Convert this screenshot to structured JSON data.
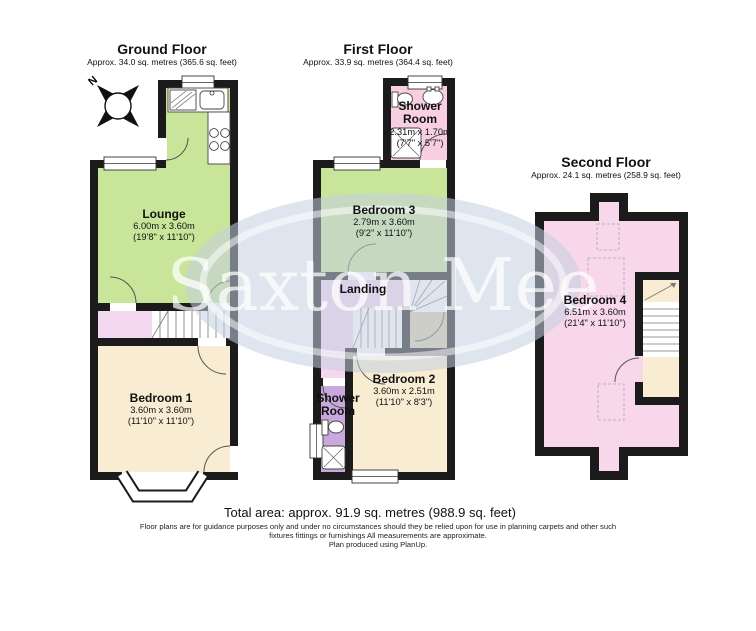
{
  "colors": {
    "wall": "#1b1b1b",
    "green": "#c8e59a",
    "cream": "#f8ecd2",
    "hallpink": "#f3d8ef",
    "showerpink": "#f7cfe1",
    "purple": "#c9a9dd",
    "tan": "#d8cdab",
    "bed4pink": "#f7d7e9",
    "watermark": "#c4d0e0"
  },
  "compass": {
    "label": "N"
  },
  "watermark": {
    "text": "Saxton Mee"
  },
  "floors": {
    "ground": {
      "title": "Ground Floor",
      "subtitle": "Approx. 34.0 sq. metres (365.6 sq. feet)"
    },
    "first": {
      "title": "First Floor",
      "subtitle": "Approx. 33.9 sq. metres (364.4 sq. feet)"
    },
    "second": {
      "title": "Second Floor",
      "subtitle": "Approx. 24.1 sq. metres (258.9 sq. feet)"
    }
  },
  "rooms": {
    "lounge": {
      "name": "Lounge",
      "metric": "6.00m x 3.60m",
      "imperial": "(19'8\" x 11'10\")"
    },
    "bedroom1": {
      "name": "Bedroom 1",
      "metric": "3.60m x 3.60m",
      "imperial": "(11'10\" x 11'10\")"
    },
    "shower1": {
      "name": "Shower Room",
      "metric": "2.31m x 1.70m",
      "imperial": "(7'7\" x 5'7\")"
    },
    "bedroom3": {
      "name": "Bedroom 3",
      "metric": "2.79m x 3.60m",
      "imperial": "(9'2\" x 11'10\")"
    },
    "landing": {
      "name": "Landing"
    },
    "bedroom2": {
      "name": "Bedroom 2",
      "metric": "3.60m x 2.51m",
      "imperial": "(11'10\" x 8'3\")"
    },
    "shower2": {
      "name": "Shower Room"
    },
    "bedroom4": {
      "name": "Bedroom 4",
      "metric": "6.51m x 3.60m",
      "imperial": "(21'4\" x 11'10\")"
    }
  },
  "footer": {
    "total_area": "Total area: approx. 91.9 sq. metres (988.9 sq. feet)",
    "disclaimer_line1": "Floor plans are for guidance purposes only and under no circumstances should they be relied upon for use in planning carpets and other such",
    "disclaimer_line2": "fixtures fittings or furnishings All measurements are approximate.",
    "disclaimer_line3": "Plan produced using PlanUp."
  }
}
